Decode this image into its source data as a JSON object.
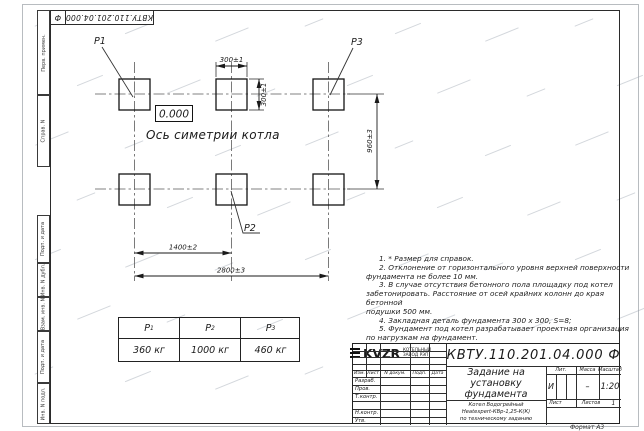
{
  "doc": {
    "number": "КВТУ.110.201.04.000",
    "suffix": "Ф",
    "full": "КВТУ.110.201.04.000  Ф"
  },
  "left_margin": {
    "items": [
      "Перв. примен.",
      "Справ. N",
      "Подп. и дата",
      "Инв. N дубл.",
      "Взам. инв. N",
      "Подп. и дата",
      "Инв. N подл."
    ]
  },
  "drawing": {
    "point_labels": {
      "p1": "P1",
      "p2": "P2",
      "p3": "P3"
    },
    "elevation": "0.000",
    "axis_label": "Ось симетрии котла",
    "dims": {
      "square_w": "300±1",
      "square_h": "300±1",
      "row_spacing": "960±3",
      "col_spacing": "1400±2",
      "total_width": "2800±3"
    }
  },
  "load_table": {
    "headers": [
      {
        "base": "P",
        "sub": "1"
      },
      {
        "base": "P",
        "sub": "2"
      },
      {
        "base": "P",
        "sub": "3"
      }
    ],
    "values": [
      "360 кг",
      "1000 кг",
      "460 кг"
    ]
  },
  "notes": {
    "lines": [
      "1. * Размер для справок.",
      "2. Отклонение от горизонтального уровня верхней поверхности",
      "фундамента не более 10 мм.",
      "3. В случае отсутствия бетонного пола площадку под котел",
      "забетонировать. Расстояние от осей крайних колонн до края бетонной",
      "подушки 500 мм.",
      "4. Закладная деталь фундамента  300 х 300, S=8;",
      "5. Фундамент под котел разрабатывает проектная организация",
      "по нагрузкам на фундамент."
    ]
  },
  "title_block": {
    "title_lines": [
      "Задание на",
      "установку",
      "фундамента"
    ],
    "subtitle_lines": [
      "Котел Водогрейный",
      "Heatexpert-КВр-1,25-К(К)",
      "по техническому заданию"
    ],
    "header_cols": [
      "Изм.",
      "Лист",
      "N докум.",
      "Подп.",
      "Дата"
    ],
    "sig_rows": [
      "Разраб.",
      "Пров.",
      "Т.контр.",
      "",
      "Н.контр.",
      "Утв."
    ],
    "lit_label": "Лит.",
    "mass_label": "Масса",
    "scale_label": "Масштаб",
    "lit_value": "И",
    "mass_value": "–",
    "scale_value": "1:20",
    "sheet_label": "Лист",
    "sheets_label": "Листов",
    "sheets_value": "1",
    "logo_text": "KVZR",
    "logo_sub1": "КОТЕЛЬНЫЙ",
    "logo_sub2": "ЗАВОД РЭП"
  },
  "footer": {
    "format": "Формат А3"
  }
}
